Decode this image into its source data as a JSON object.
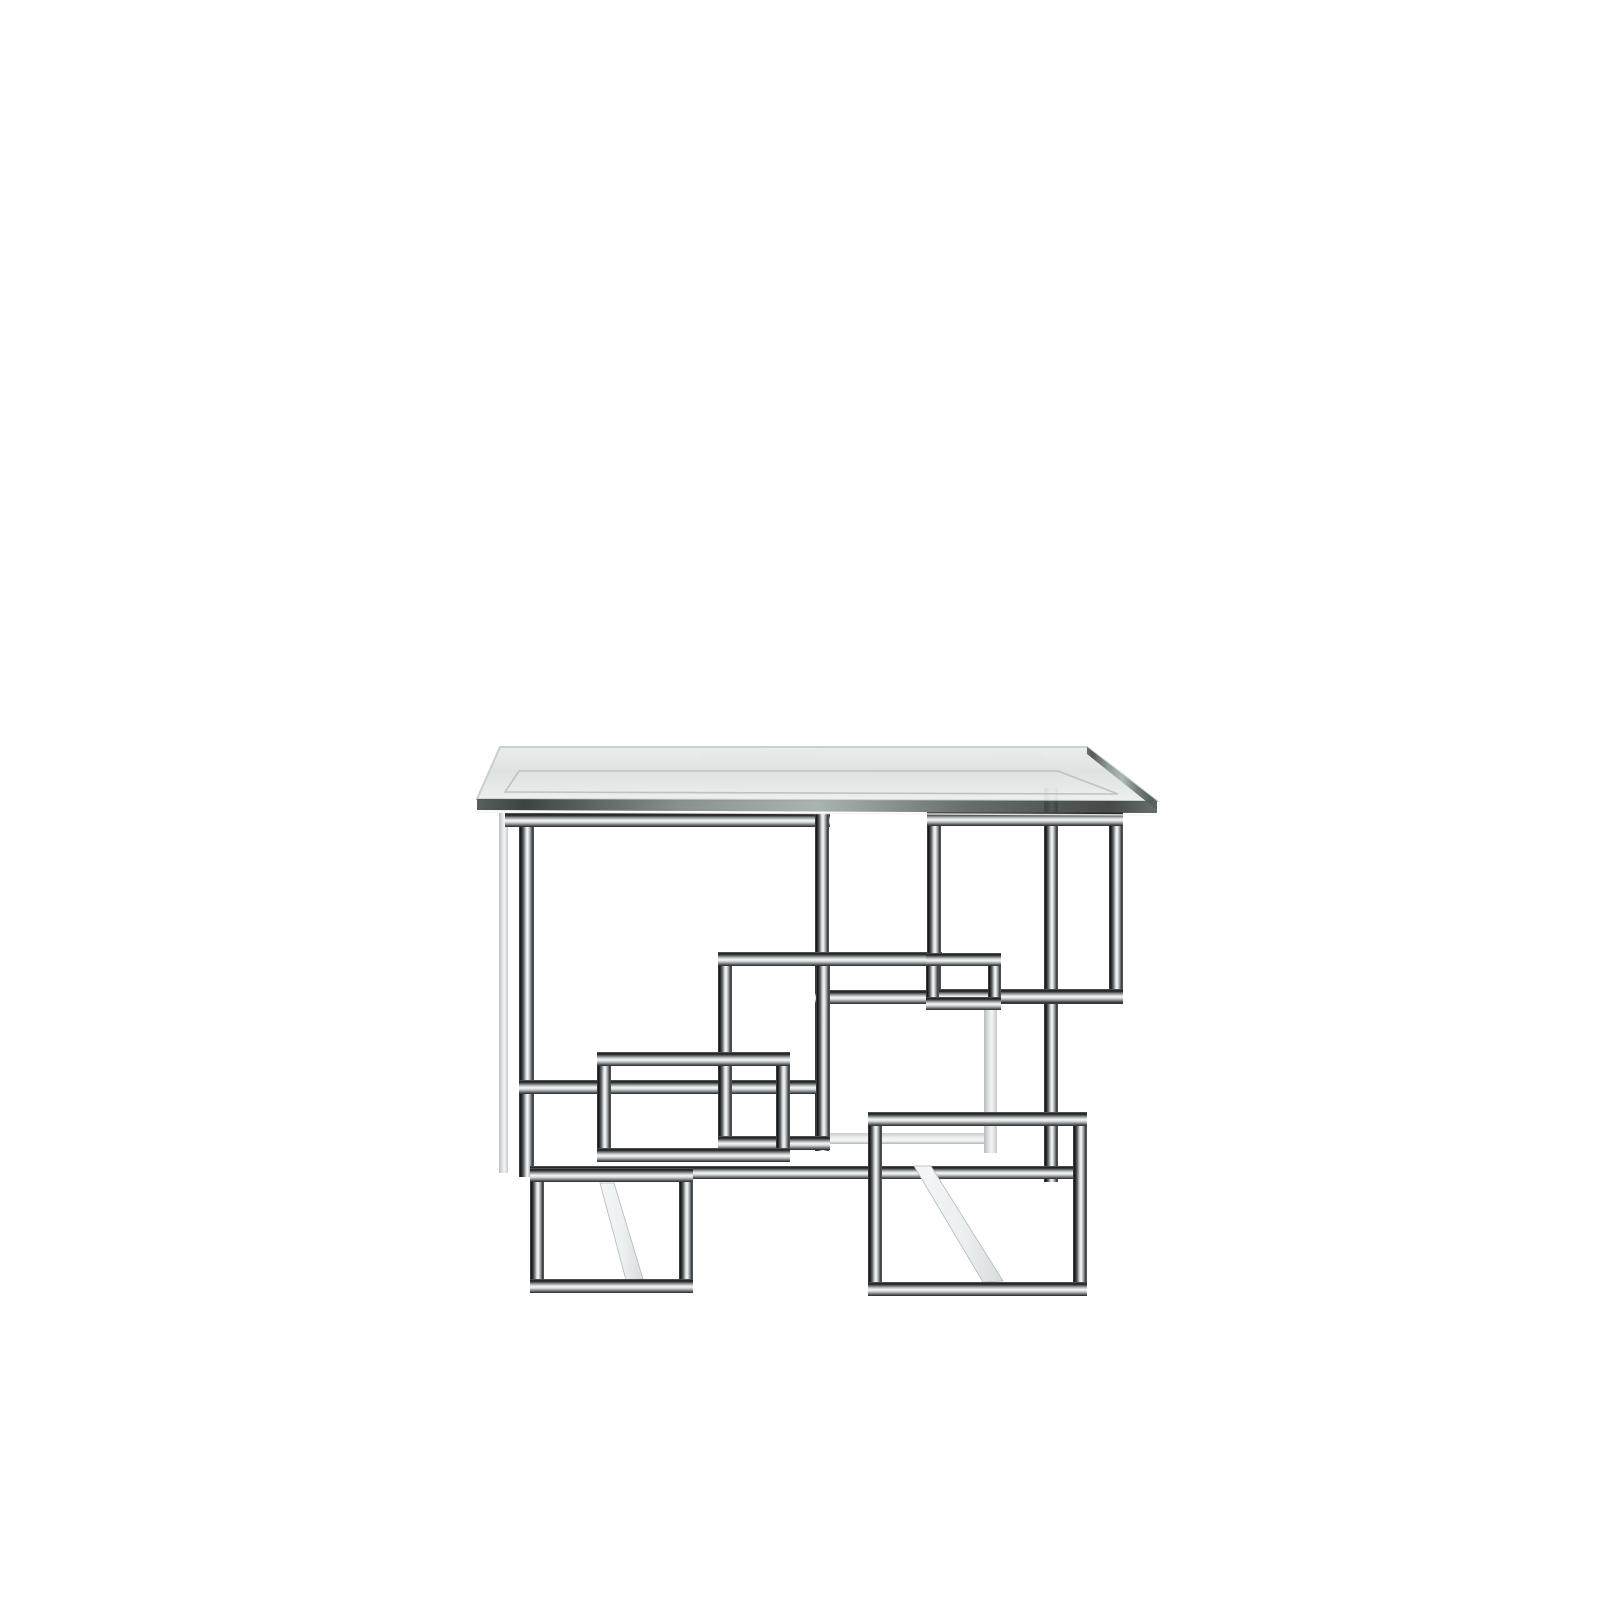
{
  "scene": {
    "description": "Product photograph of a modern square side table with a clear bevelled glass top resting on a polished chrome base made of interlocking geometric rectangles, on a plain white background",
    "background": "#ffffff",
    "palette": {
      "chrome_dark": "#17181a",
      "chrome_mid": "#8f9396",
      "chrome_light": "#f6f7f7",
      "glass_surface": "#e0e5e4",
      "glass_edge": "#343d3b"
    },
    "glass": {
      "surface": [
        [
          500,
          747
        ],
        [
          1087,
          747
        ],
        [
          1157,
          801
        ],
        [
          477,
          799
        ]
      ],
      "bevel": [
        [
          519,
          771
        ],
        [
          1058,
          771
        ],
        [
          1118,
          794
        ],
        [
          505,
          792
        ]
      ],
      "front_edge": [
        [
          477,
          799
        ],
        [
          1157,
          801
        ],
        [
          1157,
          813
        ],
        [
          477,
          810
        ]
      ],
      "right_edge": [
        [
          1087,
          747
        ],
        [
          1157,
          801
        ],
        [
          1157,
          810
        ],
        [
          1087,
          754
        ]
      ]
    },
    "reflections": [
      {
        "name": "glass-reflection-right",
        "points": [
          [
            862,
            758
          ],
          [
            1042,
            753
          ],
          [
            1064,
            792
          ],
          [
            884,
            797
          ]
        ],
        "color": "#5a6563",
        "opacity": 0.08
      },
      {
        "name": "glass-reflection-mid",
        "points": [
          [
            700,
            752
          ],
          [
            820,
            750
          ],
          [
            830,
            793
          ],
          [
            710,
            796
          ]
        ],
        "color": "#6a7472",
        "opacity": 0.05
      }
    ],
    "chrome": {
      "frames": [
        {
          "name": "top-right-frame",
          "x": 927,
          "y": 812,
          "w": 196,
          "h": 191,
          "t": 14
        },
        {
          "name": "center-square-frame",
          "x": 718,
          "y": 952,
          "w": 112,
          "h": 198,
          "t": 14
        },
        {
          "name": "connector-square-frame",
          "x": 926,
          "y": 953,
          "w": 75,
          "h": 57,
          "t": 13
        },
        {
          "name": "mid-left-frame",
          "x": 597,
          "y": 1052,
          "w": 193,
          "h": 110,
          "t": 14
        },
        {
          "name": "left-foot-frame",
          "x": 530,
          "y": 1168,
          "w": 163,
          "h": 125,
          "t": 14
        },
        {
          "name": "right-foot-frame",
          "x": 868,
          "y": 1112,
          "w": 219,
          "h": 184,
          "t": 14
        }
      ],
      "bars": [
        {
          "name": "rear-left-leg",
          "x": 499,
          "y": 813,
          "w": 9,
          "h": 360,
          "light": true
        },
        {
          "name": "front-left-leg",
          "x": 519,
          "y": 813,
          "w": 15,
          "h": 364
        },
        {
          "name": "top-rail-left",
          "x": 505,
          "y": 813,
          "w": 325,
          "h": 14
        },
        {
          "name": "center-right-vertical",
          "x": 815,
          "y": 813,
          "w": 14,
          "h": 338
        },
        {
          "name": "rear-right-leg",
          "x": 1044,
          "y": 788,
          "w": 14,
          "h": 394
        },
        {
          "name": "upper-link-rail",
          "x": 718,
          "y": 952,
          "w": 224,
          "h": 14
        },
        {
          "name": "lower-link-rail",
          "x": 815,
          "y": 990,
          "w": 308,
          "h": 14
        },
        {
          "name": "mid-rail",
          "x": 519,
          "y": 1080,
          "w": 303,
          "h": 14
        },
        {
          "name": "low-rail",
          "x": 530,
          "y": 1166,
          "w": 557,
          "h": 13
        },
        {
          "name": "rear-rail-light",
          "x": 826,
          "y": 1133,
          "w": 166,
          "h": 11,
          "light": true
        },
        {
          "name": "rear-vertical-light",
          "x": 984,
          "y": 1008,
          "w": 13,
          "h": 145,
          "light": true
        }
      ],
      "struts": [
        {
          "name": "left-diagonal-stretcher",
          "points": [
            [
              600,
              1183
            ],
            [
              614,
              1183
            ],
            [
              643,
              1279
            ],
            [
              626,
              1280
            ]
          ]
        },
        {
          "name": "right-diagonal-stretcher",
          "points": [
            [
              914,
              1166
            ],
            [
              931,
              1166
            ],
            [
              1003,
              1281
            ],
            [
              983,
              1282
            ]
          ]
        }
      ]
    }
  }
}
